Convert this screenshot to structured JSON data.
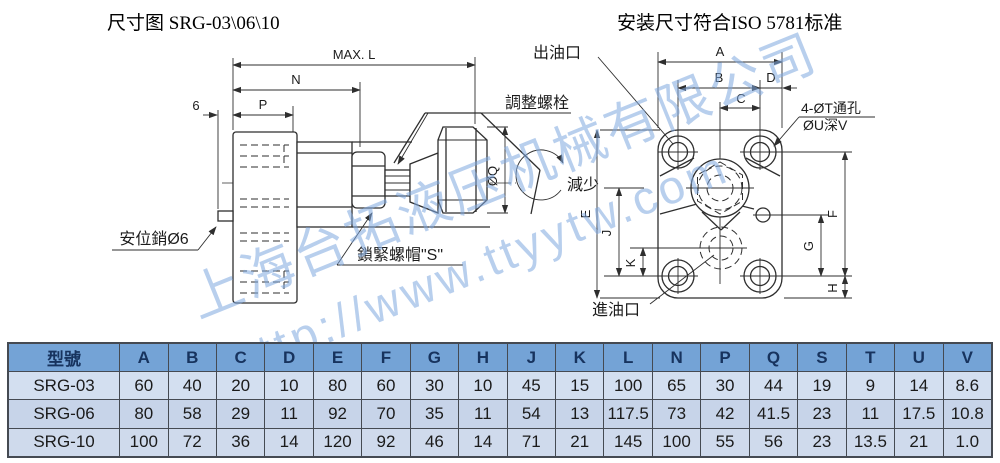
{
  "page": {
    "title_left": "尺寸图 SRG-03\\06\\10",
    "title_right": "安装尺寸符合ISO 5781标准"
  },
  "watermark": {
    "line1": "上海台拓液压机械有限公司",
    "line2": "http://www.ttyytw.com"
  },
  "side": {
    "max_l": "MAX. L",
    "n": "N",
    "p": "P",
    "six": "6",
    "adjust_bolt": "調整螺栓",
    "lock_nut": "鎖緊螺帽\"S\"",
    "position_pin": "安位銷Ø6",
    "decrease": "減少",
    "dia_q": "ØQ"
  },
  "front": {
    "outlet": "出油口",
    "inlet": "進油口",
    "through_holes": "4-ØT通孔",
    "counterbore": "ØU深V",
    "a": "A",
    "b": "B",
    "c": "C",
    "d": "D",
    "e": "E",
    "f": "F",
    "g": "G",
    "h": "H",
    "j": "J",
    "k": "K"
  },
  "table": {
    "headers": [
      "型號",
      "A",
      "B",
      "C",
      "D",
      "E",
      "F",
      "G",
      "H",
      "J",
      "K",
      "L",
      "N",
      "P",
      "Q",
      "S",
      "T",
      "U",
      "V"
    ],
    "rows": [
      [
        "SRG-03",
        "60",
        "40",
        "20",
        "10",
        "80",
        "60",
        "30",
        "10",
        "45",
        "15",
        "100",
        "65",
        "30",
        "44",
        "19",
        "9",
        "14",
        "8.6"
      ],
      [
        "SRG-06",
        "80",
        "58",
        "29",
        "11",
        "92",
        "70",
        "35",
        "11",
        "54",
        "13",
        "117.5",
        "73",
        "42",
        "41.5",
        "23",
        "11",
        "17.5",
        "10.8"
      ],
      [
        "SRG-10",
        "100",
        "72",
        "36",
        "14",
        "120",
        "92",
        "46",
        "14",
        "71",
        "21",
        "145",
        "100",
        "55",
        "56",
        "23",
        "13.5",
        "21",
        "1.0"
      ]
    ]
  },
  "colors": {
    "header_bg": "#74a3d6",
    "row_a": "#d3dff0",
    "row_b": "#c7d4e9",
    "row_c": "#cfdaec",
    "border": "#454a52",
    "line": "#2e2e2e",
    "watermark": "#7fa8e0",
    "header_text": "#17335e",
    "cell_text": "#1b1b1b"
  }
}
